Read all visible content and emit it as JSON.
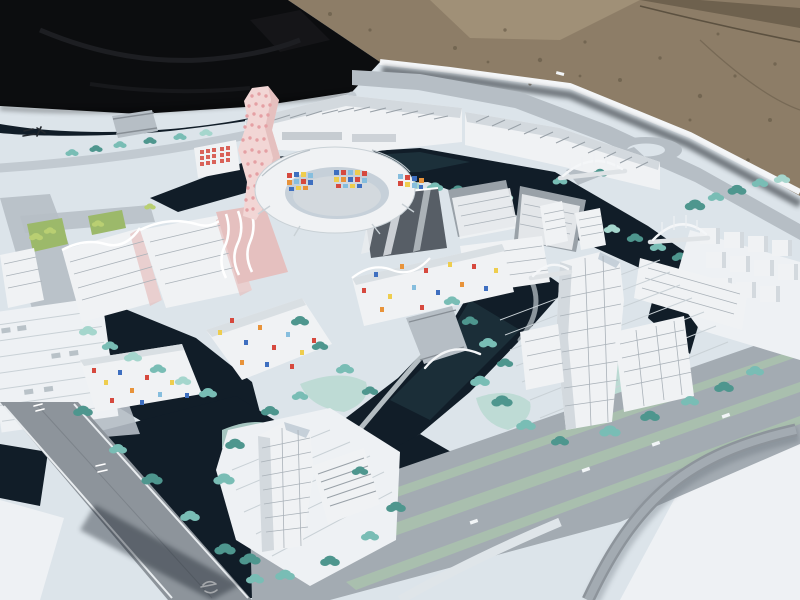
{
  "scene": {
    "title": "Outdoor photograph of a white architectural scale model of a waterfront urban master plan",
    "environment": {
      "backdrop_upper_left": "black tarp fabric",
      "backdrop_upper_right": "brown gravel ground with crack",
      "base": "white model board photographed at an oblique angle"
    },
    "landmarks": [
      "curvy pink tower with dot-pattern facade",
      "circular courtyard building with colored mosaic inner facade",
      "row of exhibition halls with ribbed sawtooth roofs",
      "red-grid facade block",
      "cream mid-rise blocks with wavy roof lines",
      "dark glass office block",
      "low-rise buildings speckled with confetti-colored windows",
      "translucent white high-rise tower with sawtooth podium",
      "riverside twin high-rise cluster",
      "cluster of white cube housing blocks",
      "white arched pedestrian bridges over canals",
      "dark canal network",
      "teal model trees along boulevards",
      "roundabout and perimeter road",
      "multi-lane highway with green medians and curved flyover"
    ],
    "road_markings": "tiny illegible Chinese road-name characters painted in black on the board edge and in white on the roads"
  },
  "palette": {
    "tarp": "#0c0d0f",
    "tarpSheen": "#1d1e22",
    "gravel": "#8d7d67",
    "gravelDark": "#6e614e",
    "gravelLight": "#a09077",
    "board": "#dce4ea",
    "boardBright": "#eef1f4",
    "boardShade": "#c6d0d9",
    "water": "#111d28",
    "waterTeal": "#27444c",
    "road": "#b6bec5",
    "roadMid": "#a3abb2",
    "roadDark": "#8d949b",
    "roadCurve": "#c2cad1",
    "median": "#a9bfae",
    "grass": "#9cb96a",
    "lawn": "#b7d8d0",
    "bank": "#dde6e9",
    "tree": "#79bdb5",
    "treeDark": "#4e968e",
    "treeLight": "#a5d6cd",
    "grassTree": "#b9cf72",
    "buildingWhite": "#f0f2f4",
    "buildingShade": "#d3d9de",
    "buildingDark": "#aab2b9",
    "buildingRoof": "#99a1a8",
    "glass": "#575e66",
    "pinkTower": "#f2d6d5",
    "pinkTowerShade": "#e5c0bf",
    "pinkDot": "#e5a0a4",
    "mosaicRed": "#d6493e",
    "mosaicBlue": "#3e6fc0",
    "mosaicOrange": "#e8933a",
    "mosaicYellow": "#eecd4e",
    "mosaicSky": "#86bede"
  }
}
